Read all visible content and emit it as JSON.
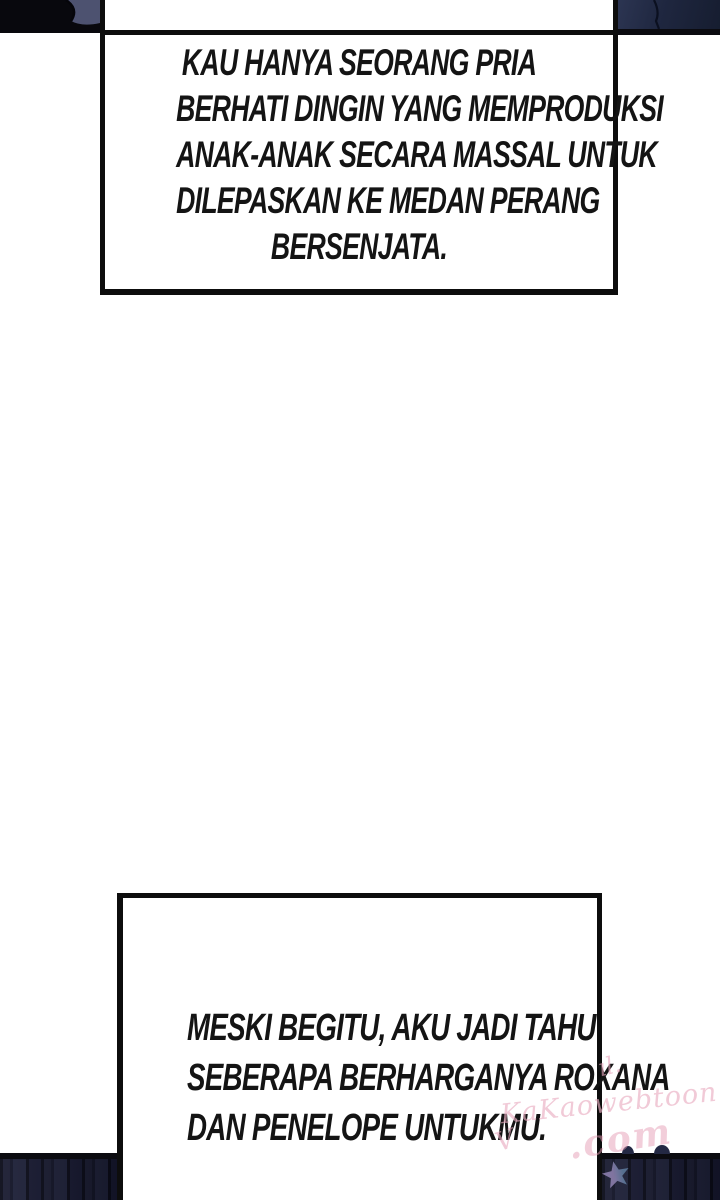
{
  "comic": {
    "boxes": {
      "top": {
        "lines": [
          "KAU HANYA SEORANG PRIA",
          "BERHATI DINGIN YANG MEMPRODUKSI",
          "ANAK-ANAK SECARA MASSAL UNTUK",
          "DILEPASKAN KE MEDAN PERANG",
          "BERSENJATA."
        ]
      },
      "bottom": {
        "lines": [
          "MESKI BEGITU, AKU JADI TAHU",
          "SEBERAPA BERHARGANYA ROXANA",
          "DAN PENELOPE UNTUKMU."
        ]
      }
    },
    "watermark": {
      "flourish_top": "ıl.",
      "main": "KaKaowebtoon",
      "domain": ".com",
      "flourish_left": "V",
      "color": "#e9aec2"
    },
    "colors": {
      "background": "#ffffff",
      "border_ink": "#0d0d0d",
      "text_ink": "#141414",
      "panel_black": "#08080d",
      "panel_navy": "#1f2740",
      "panel_navy_light": "#2c3552",
      "panel_slate": "#4d5270",
      "stripe_dark": "#0a0b18",
      "stripe_base": "#191b31",
      "star_purple": "#9183b3",
      "star_blue": "#5e7d9e"
    }
  }
}
